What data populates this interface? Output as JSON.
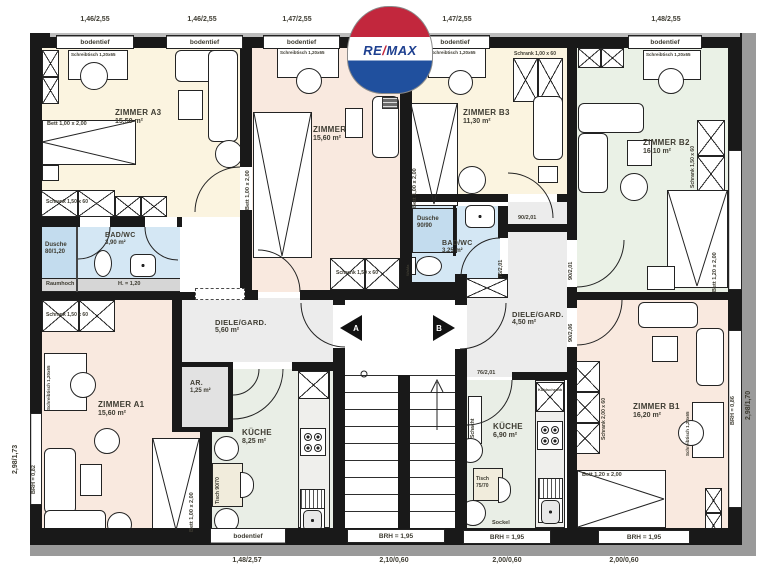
{
  "logo": {
    "re": "RE",
    "slash": "/",
    "max": "MAX"
  },
  "colors": {
    "wall": "#191919",
    "cream": "#fbf4e0",
    "pink": "#f9e9df",
    "green": "#eaf1e6",
    "kitchen": "#e9eee6",
    "bath": "#d4e7f4",
    "shower": "#c3dcee",
    "hall": "#ececec",
    "remax_red": "#c2273d",
    "remax_blue": "#20509e"
  },
  "dims": {
    "top": [
      "1,46/2,55",
      "1,46/2,55",
      "1,47/2,55",
      "1,47/2,55",
      "1,48/2,55"
    ],
    "bottom": [
      "1,48/2,57",
      "2,10/0,60",
      "2,00/0,60",
      "2,00/0,60"
    ],
    "left": "2,98/1,73",
    "right": "2,98/1,70"
  },
  "windows": {
    "bodentief": "bodentief",
    "brh_195": "BRH = 1,95",
    "brh_082": "BRH = 0,82",
    "brh_086": "BRH = 0,86",
    "sockel": "Sockel"
  },
  "rooms": {
    "a3": {
      "name": "ZIMMER A3",
      "area": "15,50 m²"
    },
    "mitte": {
      "name": "ZIMMER",
      "area": "15,60 m²"
    },
    "b3": {
      "name": "ZIMMER B3",
      "area": "11,30 m²"
    },
    "b2": {
      "name": "ZIMMER B2",
      "area": "16,10 m²"
    },
    "a1": {
      "name": "ZIMMER A1",
      "area": "15,60 m²"
    },
    "b1": {
      "name": "ZIMMER B1",
      "area": "16,20 m²"
    },
    "bad_a": {
      "name": "BAD/WC",
      "area": "3,90 m²"
    },
    "bad_b": {
      "name": "BAD/WC",
      "area": "3,25 m²"
    },
    "dusche_a": {
      "name": "Dusche",
      "size": "80/1,20"
    },
    "dusche_b": {
      "name": "Dusche",
      "size": "90/90"
    },
    "diele_a": {
      "name": "DIELE/GARD.",
      "area": "5,60 m²"
    },
    "diele_b": {
      "name": "DIELE/GARD.",
      "area": "4,50 m²"
    },
    "ar": {
      "name": "AR.",
      "area": "1,25 m²"
    },
    "kueche_a": {
      "name": "KÜCHE",
      "area": "8,25 m²"
    },
    "kueche_b": {
      "name": "KÜCHE",
      "area": "6,90 m²"
    }
  },
  "furniture": {
    "bett_100": "Bett 1,00 x 2,00",
    "bett_120": "Bett 1,20 x 2,00",
    "schrank_150": "Schrank 1,50 x 60",
    "schrank_100": "Schrank 1,00 x 60",
    "schrank_200": "Schrank 2,00 x 60",
    "schreibtisch": "Schreibtisch 1,20x65",
    "tisch_9070": "Tisch 90/70",
    "tisch_7570": "Tisch 75/70",
    "kuehlschrank": "Kühlschrank",
    "schacht": "Schacht",
    "wama": "WaMa"
  },
  "doors": {
    "d90201": "90/2,01",
    "d76201": "76/2,01",
    "d90206": "90/2,06"
  },
  "annotations": {
    "raumhoch": "Raumhoch",
    "h120": "H. = 1,20"
  },
  "markers": {
    "a": "A",
    "b": "B"
  }
}
